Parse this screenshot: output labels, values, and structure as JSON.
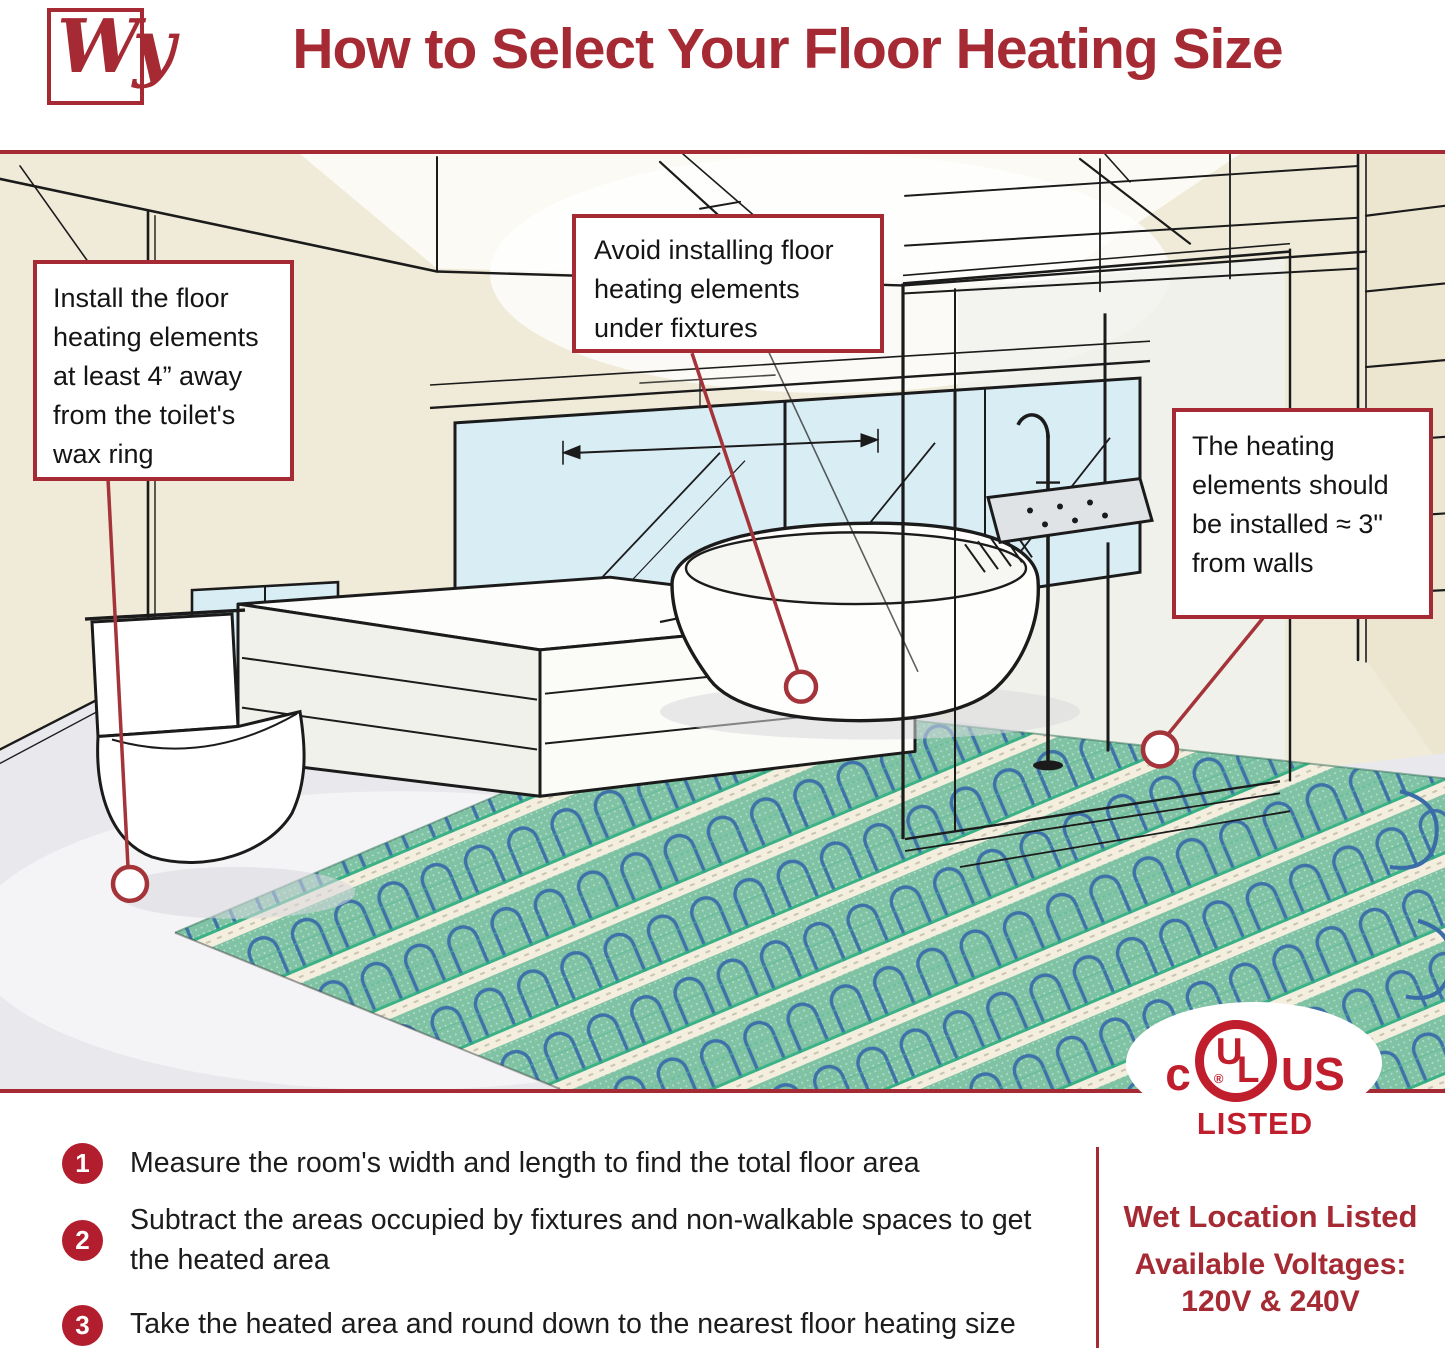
{
  "header": {
    "logo_text": "Wy",
    "title": "How to Select Your Floor Heating Size"
  },
  "callouts": {
    "toilet": "Install the floor heating elements at least 4” away from the toilet's wax ring",
    "fixtures": "Avoid installing floor heating elements under fixtures",
    "walls": "The heating elements should be installed ≈ 3\" from walls"
  },
  "certification": {
    "prefix": "c",
    "u": "U",
    "l": "L",
    "registered": "®",
    "suffix": "US",
    "listed": "LISTED"
  },
  "steps": [
    {
      "number": "1",
      "text": "Measure the room's width and length to find the total floor area"
    },
    {
      "number": "2",
      "text": "Subtract the areas occupied by fixtures and non-walkable spaces to get the heated area"
    },
    {
      "number": "3",
      "text": "Take the heated area and round down to the nearest floor heating size"
    }
  ],
  "footer_right": {
    "line1": "Wet Location Listed",
    "line2": "Available Voltages:",
    "line3": "120V & 240V"
  },
  "colors": {
    "accent_red": "#A62A33",
    "badge_red": "#B21E2E",
    "ul_red": "#C01E2D",
    "wall_cream": "#F0EBD9",
    "floor_gray": "#E9E9ED",
    "window_blue": "#D9EDF5",
    "mat_green": "#7FC2A4",
    "mat_stripe": "#F3EEDD",
    "cable_blue": "#3A6CA8"
  }
}
